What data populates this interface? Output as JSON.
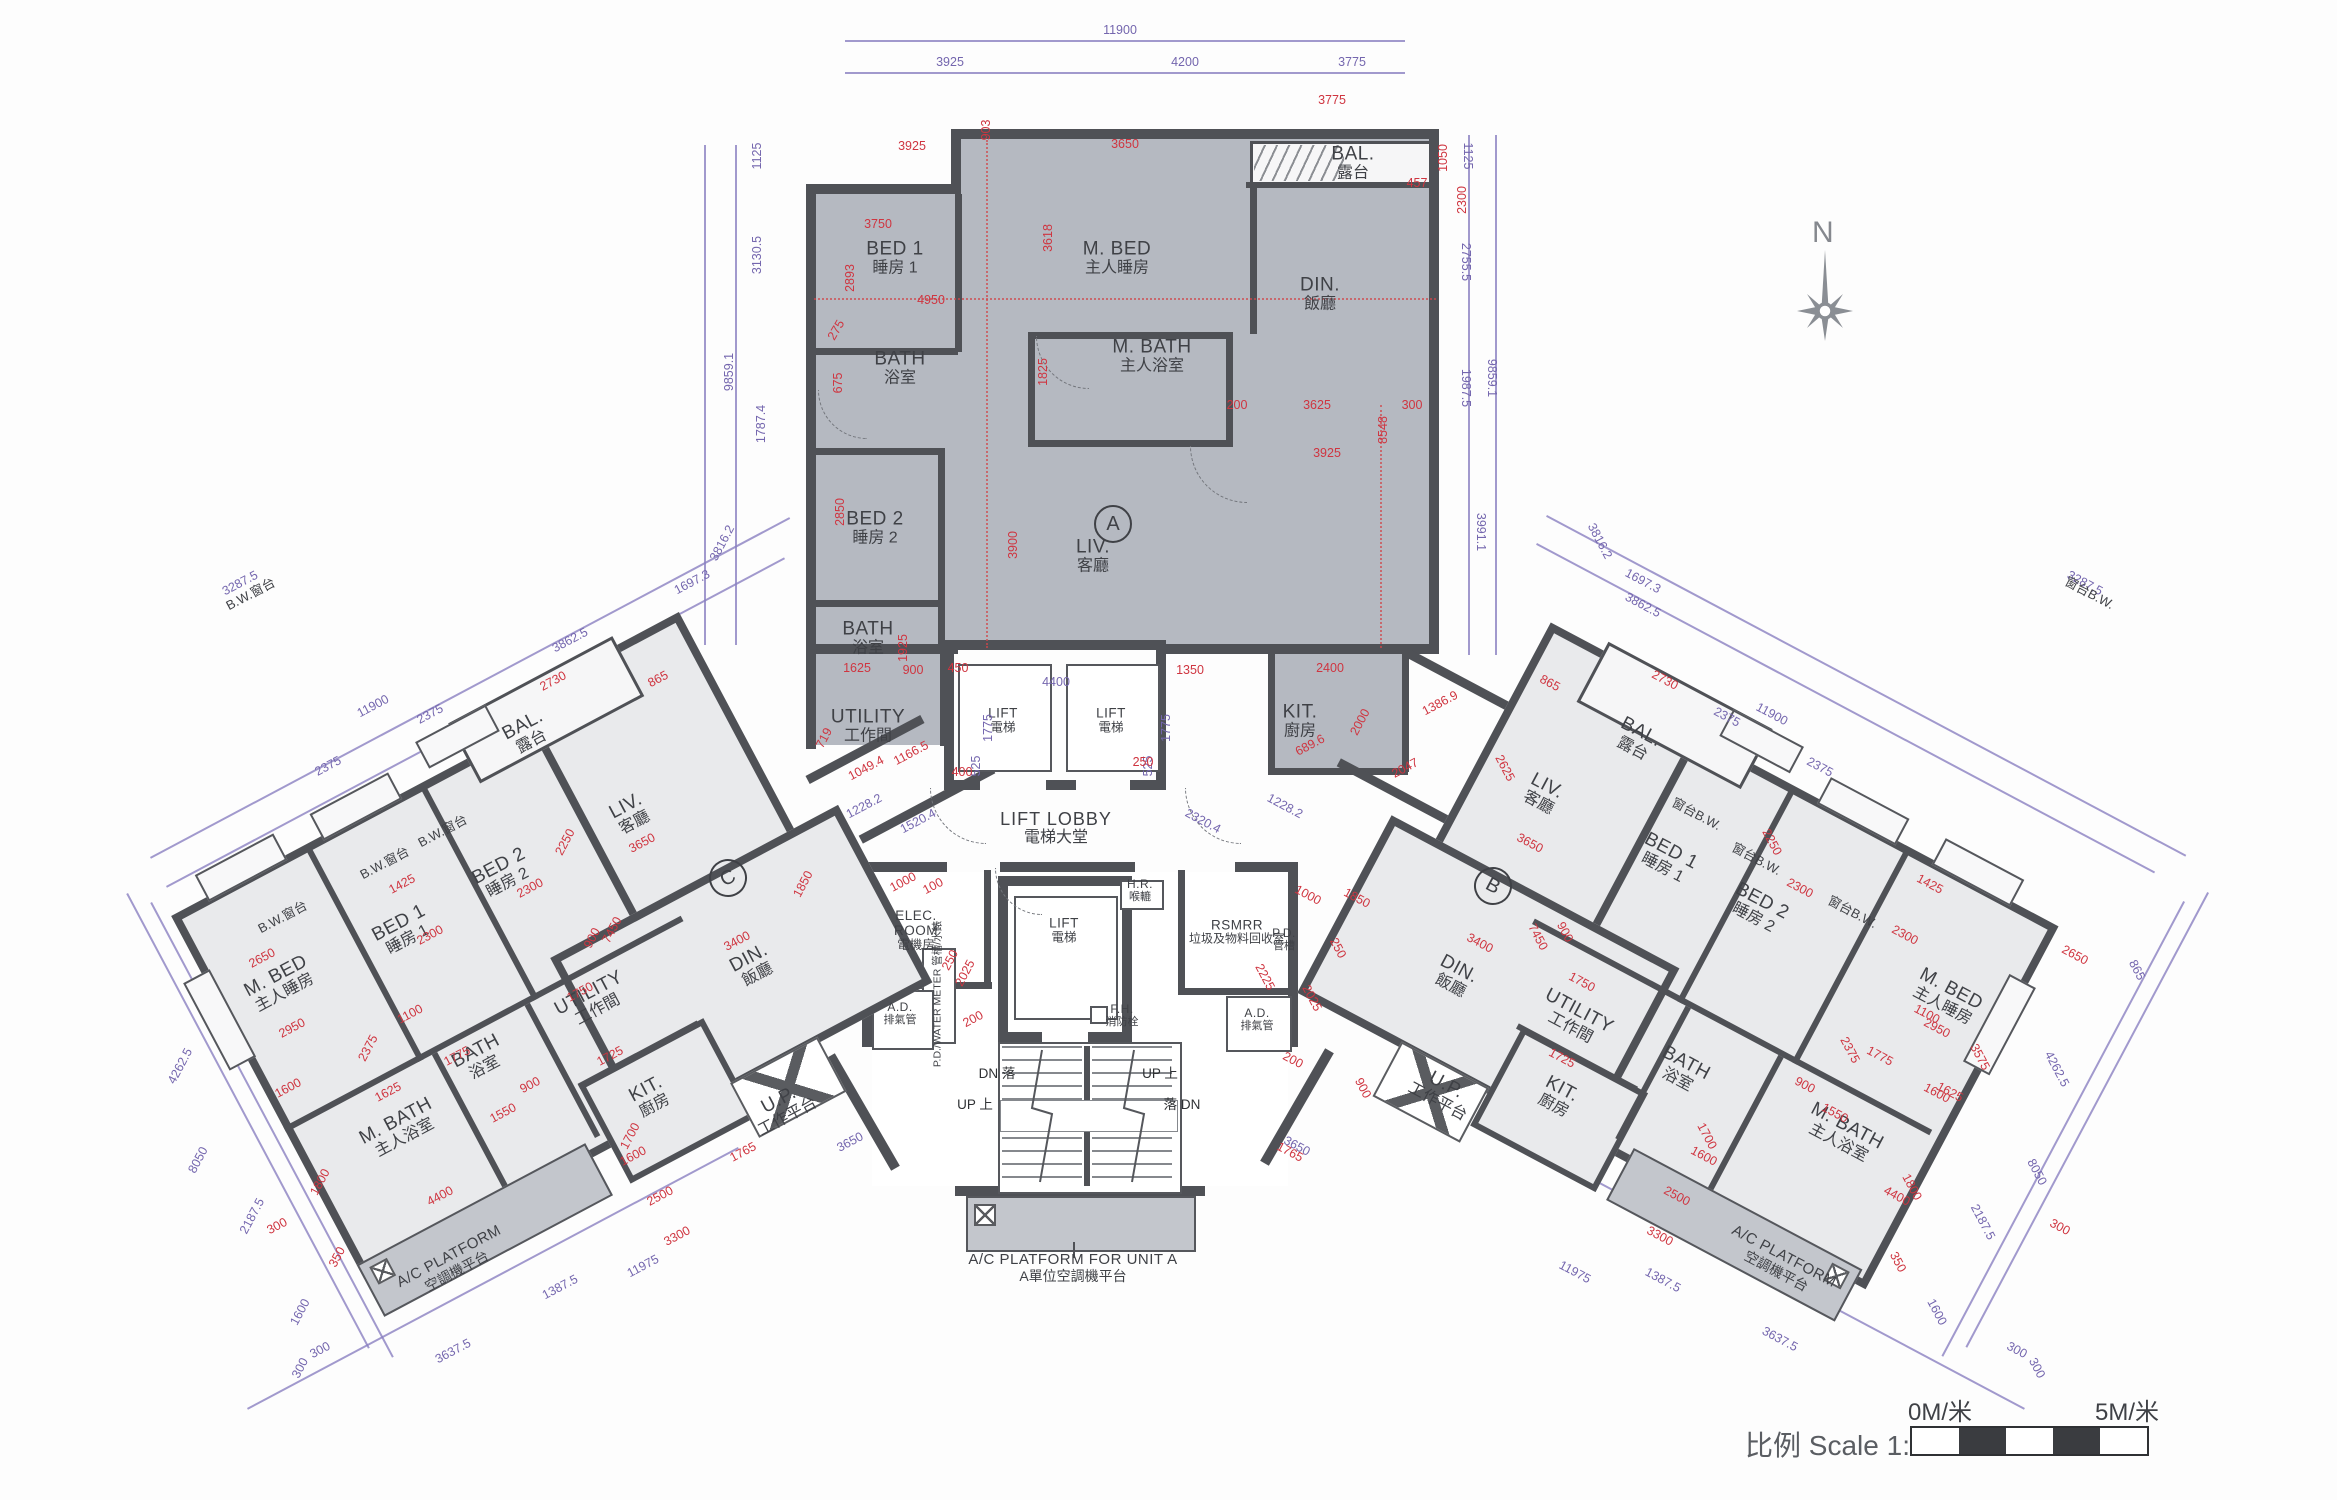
{
  "drawing": {
    "north_label": "N",
    "scale": {
      "prefix_zh": "比例",
      "text": "Scale 1:150",
      "start": "0M/米",
      "end": "5M/米"
    },
    "colors": {
      "unit_a_fill": "#b5b9c1",
      "wing_fill": "#e9eaec",
      "wall": "#4f5156",
      "dim_red": "#cf3540",
      "dim_purple": "#7466ae",
      "platform_fill": "#c3c6cc"
    }
  },
  "core": {
    "lift_lobby": {
      "en": "LIFT LOBBY",
      "zh": "電梯大堂"
    },
    "lift_a": {
      "en": "LIFT",
      "zh": "電梯"
    },
    "lift_b": {
      "en": "LIFT",
      "zh": "電梯"
    },
    "lift_main": {
      "en": "LIFT",
      "zh": "電梯"
    },
    "elec_room": {
      "en": "ELEC. ROOM",
      "zh": "電機房"
    },
    "rsmrr": {
      "en": "RSMRR",
      "zh": "垃圾及物料回收室"
    },
    "ad_left": {
      "en": "A.D.",
      "zh": "排氣管"
    },
    "ad_right": {
      "en": "A.D.",
      "zh": "排氣管"
    },
    "pd_water_meter": {
      "en": "P.D./WATER METER",
      "zh": "管槽/水錶"
    },
    "pd": {
      "en": "P.D.",
      "zh": "管槽"
    },
    "hr": {
      "en": "H.R.",
      "zh": "喉轆"
    },
    "fh": {
      "en": "F.H.",
      "zh": "消防栓"
    },
    "stairs": [
      "DN 落",
      "UP 上",
      "UP 上",
      "落 DN"
    ],
    "ac_platform_a": {
      "en": "A/C PLATFORM FOR UNIT A",
      "zh": "A單位空調機平台"
    }
  },
  "units": {
    "a": {
      "letter": "A",
      "rooms": [
        {
          "en": "BED 1",
          "zh": "睡房 1"
        },
        {
          "en": "BATH",
          "zh": "浴室"
        },
        {
          "en": "M. BED",
          "zh": "主人睡房"
        },
        {
          "en": "M. BATH",
          "zh": "主人浴室"
        },
        {
          "en": "DIN.",
          "zh": "飯廳"
        },
        {
          "en": "BAL.",
          "zh": "露台"
        },
        {
          "en": "BED 2",
          "zh": "睡房 2"
        },
        {
          "en": "LIV.",
          "zh": "客廳"
        },
        {
          "en": "BATH",
          "zh": "浴室"
        },
        {
          "en": "UTILITY",
          "zh": "工作間"
        },
        {
          "en": "KIT.",
          "zh": "廚房"
        }
      ]
    },
    "b": {
      "letter": "B",
      "bw": "窗台B.W.",
      "ac": {
        "en": "A/C PLATFORM",
        "zh": "空調機平台"
      },
      "rooms": [
        {
          "en": "LIV.",
          "zh": "客廳"
        },
        {
          "en": "DIN.",
          "zh": "飯廳"
        },
        {
          "en": "BED 1",
          "zh": "睡房 1"
        },
        {
          "en": "BED 2",
          "zh": "睡房 2"
        },
        {
          "en": "M. BED",
          "zh": "主人睡房"
        },
        {
          "en": "UTILITY",
          "zh": "工作間"
        },
        {
          "en": "BATH",
          "zh": "浴室"
        },
        {
          "en": "M. BATH",
          "zh": "主人浴室"
        },
        {
          "en": "KIT.",
          "zh": "廚房"
        },
        {
          "en": "U.P.",
          "zh": "工作平台"
        },
        {
          "en": "BAL.",
          "zh": "露台"
        }
      ]
    },
    "c": {
      "letter": "C",
      "bw": "B.W.窗台",
      "ac": {
        "en": "A/C PLATFORM",
        "zh": "空調機平台"
      },
      "rooms": [
        {
          "en": "M. BED",
          "zh": "主人睡房"
        },
        {
          "en": "BED 1",
          "zh": "睡房 1"
        },
        {
          "en": "BED 2",
          "zh": "睡房 2"
        },
        {
          "en": "LIV.",
          "zh": "客廳"
        },
        {
          "en": "DIN.",
          "zh": "飯廳"
        },
        {
          "en": "UTILITY",
          "zh": "工作間"
        },
        {
          "en": "BATH",
          "zh": "浴室"
        },
        {
          "en": "M. BATH",
          "zh": "主人浴室"
        },
        {
          "en": "KIT.",
          "zh": "廚房"
        },
        {
          "en": "U.P.",
          "zh": "工作平台"
        },
        {
          "en": "BAL.",
          "zh": "露台"
        }
      ]
    }
  },
  "dims": {
    "top_outer": [
      "11900",
      "3925",
      "4200",
      "3775"
    ],
    "a_left": [
      "1125",
      "3130.5",
      "9859.1",
      "1787.4",
      "3816.2",
      "1697.3"
    ],
    "a_right": [
      "1125",
      "2755.5",
      "1987.5",
      "9859.1",
      "3991.1",
      "3816.2",
      "1697.3"
    ],
    "lobby": [
      "4400",
      "1775",
      "1775",
      "525",
      "525",
      "1520.4",
      "1228.2",
      "2320.4",
      "1228.2"
    ],
    "a_inner": [
      "3925",
      "3650",
      "3775",
      "903",
      "3750",
      "3618",
      "2893",
      "275",
      "675",
      "4950",
      "1825",
      "3900",
      "2850",
      "1925",
      "1625",
      "900",
      "1350",
      "2400",
      "2000",
      "689.6",
      "2047",
      "1386.9",
      "3625",
      "300",
      "200",
      "8548",
      "3925",
      "1050",
      "2300",
      "457",
      "450",
      "400",
      "250",
      "1166.5",
      "1049.4",
      "719"
    ],
    "center": [
      "2225",
      "2025",
      "1850",
      "1000",
      "250",
      "900",
      "200",
      "1765",
      "1765",
      "1850",
      "1000",
      "100",
      "250",
      "2025",
      "200"
    ],
    "c_outer": [
      "3287.5",
      "11900",
      "2375",
      "2375",
      "3862.5",
      "4262.5",
      "8050",
      "2187.5",
      "1600",
      "300",
      "300",
      "3637.5",
      "1387.5",
      "11975",
      "3650"
    ],
    "c_inner": [
      "2730",
      "865",
      "2650",
      "1425",
      "2300",
      "2300",
      "2250",
      "3650",
      "2950",
      "7450",
      "900",
      "1750",
      "1725",
      "2375",
      "1600",
      "1100",
      "1775",
      "1625",
      "1550",
      "900",
      "1800",
      "4400",
      "350",
      "300",
      "2500",
      "1700",
      "3400",
      "1600",
      "3300"
    ],
    "b_outer": [
      "3287.5",
      "11900",
      "2375",
      "2375",
      "3862.5",
      "4262.5",
      "8050",
      "2187.5",
      "1600",
      "300",
      "300",
      "3637.5",
      "1387.5",
      "11975",
      "3650",
      "865"
    ],
    "b_inner": [
      "2730",
      "865",
      "2650",
      "1425",
      "2300",
      "2300",
      "2250",
      "3650",
      "2950",
      "7450",
      "900",
      "1750",
      "1725",
      "2375",
      "1600",
      "1100",
      "1775",
      "1625",
      "1550",
      "900",
      "1800",
      "4400",
      "350",
      "300",
      "2500",
      "1700",
      "3400",
      "1600",
      "3300",
      "2625",
      "3575"
    ]
  }
}
